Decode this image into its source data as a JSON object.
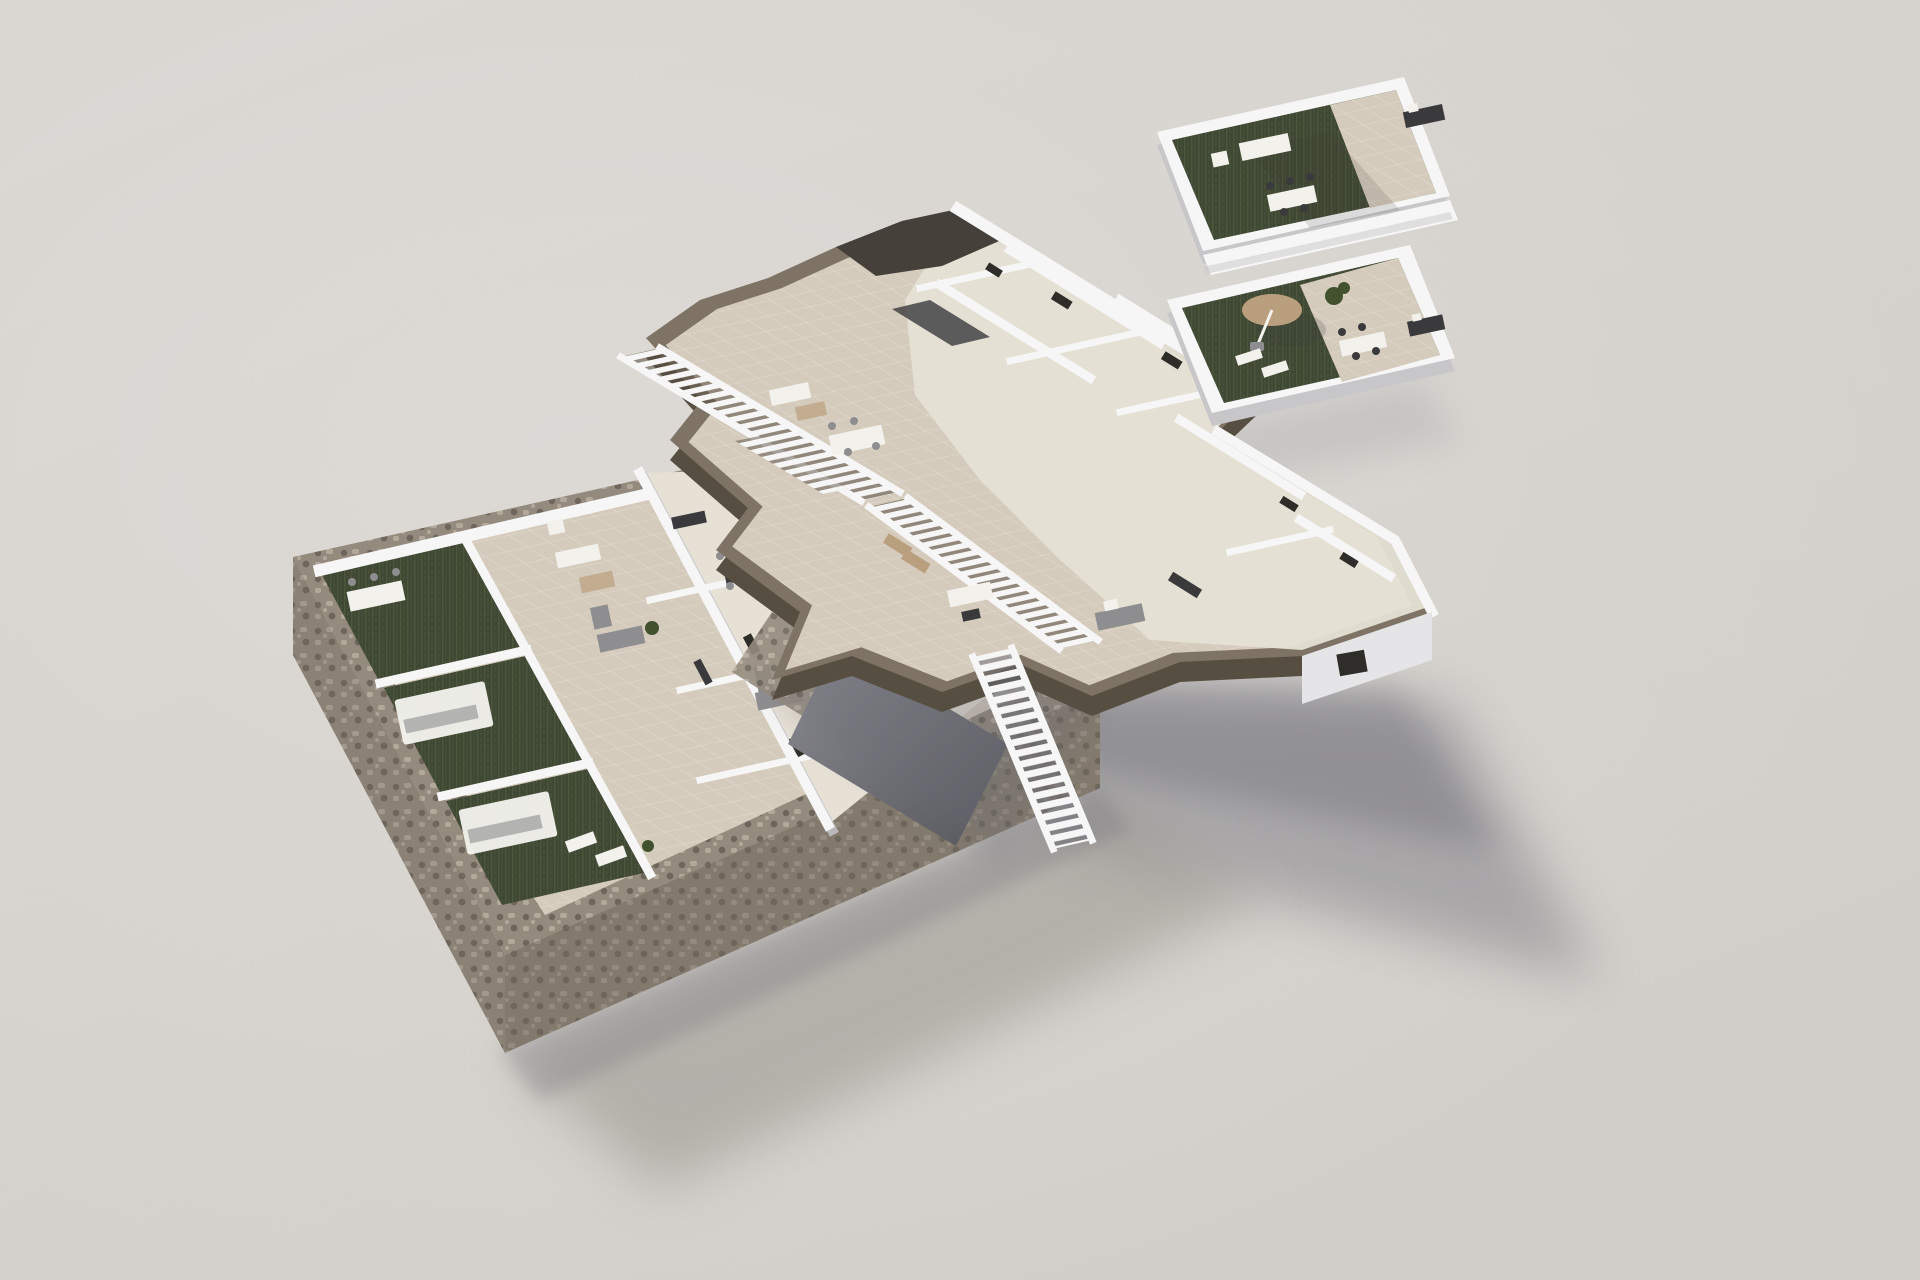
{
  "scene": {
    "title": "Exploded 3D floor-plan rendering of a residential building",
    "view": "axonometric aerial, three levels separated vertically over a plain studio backdrop",
    "floors": [
      {
        "id": "ground-floor",
        "label": "Ground floor on stone plinth",
        "features": [
          "rubble-stone perimeter base",
          "three artificial-turf private gardens",
          "white pergolas with dining sets",
          "tiled patios",
          "white-walled rooms with grey sofas and dark dining tables",
          "dark driveway ramp"
        ]
      },
      {
        "id": "first-floor",
        "label": "First floor slab with jagged cut edge",
        "features": [
          "taupe slab edge band",
          "two long open-riser external staircases",
          "lower connecting stair",
          "tiled terraces with lounge and dining furniture",
          "white-walled bedrooms and bathrooms"
        ]
      },
      {
        "id": "roof-terrace",
        "label": "Roof terrace (solarium)",
        "features": [
          "white parapet walls",
          "dark artificial-turf decks",
          "tiled sun decks",
          "tan parasol with loungers",
          "white outdoor sofas and dining tables",
          "planters"
        ]
      }
    ],
    "lighting": "soft daylight from upper left, long soft shadows cast to lower right"
  },
  "colors": {
    "bg_top": "#d8d5d1",
    "bg_bottom": "#d2cfca",
    "bg_light": "#e2dfdb",
    "wall_white": "#f6f6f6",
    "wall_shade": "#c7c7ca",
    "wall_dark": "#9c9ca2",
    "floor_tile": "#d5cbbc",
    "floor_light": "#e6e0d5",
    "turf": "#3f4833",
    "turf_light": "#5c684a",
    "stone": "#948a7d",
    "stone_dark": "#6e665c",
    "stone_light": "#b3a99b",
    "band_brown": "#7e7365",
    "band_brown_dark": "#574e42",
    "roof_dark": "#45413a",
    "ramp_light": "#8d8d94",
    "ramp_dark": "#55555c",
    "shadow": "#6c6c74",
    "shadow_soft": "#98948d",
    "furn_dark": "#3a3a3c",
    "furn_gray": "#8e8e90",
    "furn_white": "#f3f1ec",
    "furn_tan": "#b99f7e",
    "opening_dark": "#2f2d2a",
    "plant_green": "#42522f"
  }
}
